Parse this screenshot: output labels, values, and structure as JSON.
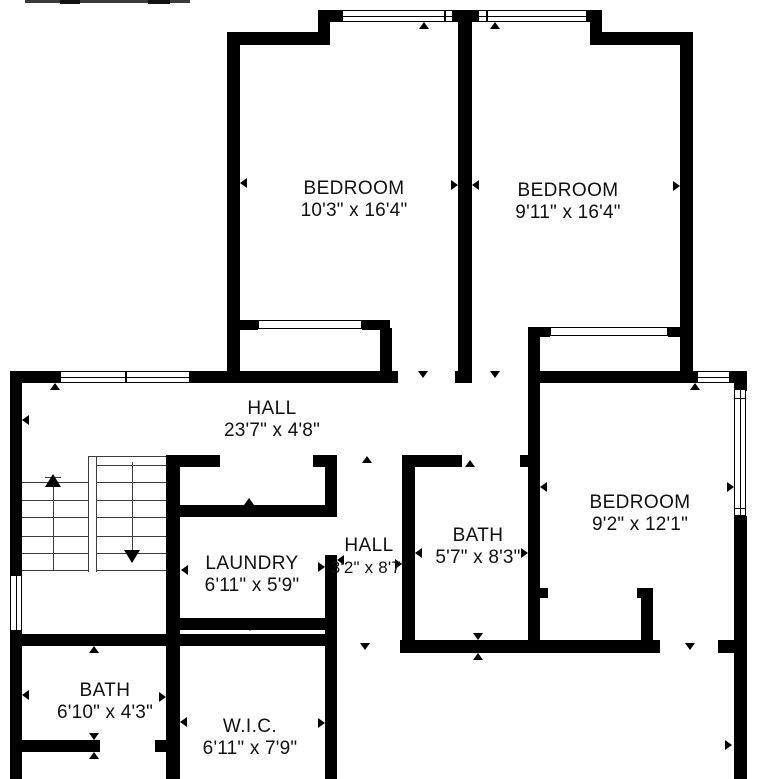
{
  "canvas": {
    "width": 779,
    "height": 779,
    "background": "#ffffff",
    "wall_color": "#000000",
    "stair_line_color": "#3d3d3d",
    "text_color": "#111111"
  },
  "rooms": [
    {
      "name": "BEDROOM",
      "dims": "10'3\" x 16'4\"",
      "x": 354,
      "y": 200,
      "small": false
    },
    {
      "name": "BEDROOM",
      "dims": "9'11\" x 16'4\"",
      "x": 568,
      "y": 202,
      "small": false
    },
    {
      "name": "HALL",
      "dims": "23'7\" x 4'8\"",
      "x": 272,
      "y": 420,
      "small": false
    },
    {
      "name": "BEDROOM",
      "dims": "9'2\" x 12'1\"",
      "x": 640,
      "y": 514,
      "small": false
    },
    {
      "name": "LAUNDRY",
      "dims": "6'11\" x 5'9\"",
      "x": 252,
      "y": 575,
      "small": false
    },
    {
      "name": "HALL",
      "dims": "3'2\" x 8'7\"",
      "x": 369,
      "y": 557,
      "small": true
    },
    {
      "name": "BATH",
      "dims": "5'7\" x 8'3\"",
      "x": 478,
      "y": 547,
      "small": false
    },
    {
      "name": "BATH",
      "dims": "6'10\" x 4'3\"",
      "x": 105,
      "y": 702,
      "small": false
    },
    {
      "name": "W.I.C.",
      "dims": "6'11\" x 7'9\"",
      "x": 250,
      "y": 738,
      "small": false
    }
  ],
  "walls": [
    [
      318,
      10,
      284,
      12
    ],
    [
      318,
      10,
      12,
      35
    ],
    [
      227,
      32,
      103,
      13
    ],
    [
      227,
      32,
      13,
      351
    ],
    [
      590,
      10,
      12,
      35
    ],
    [
      590,
      32,
      103,
      13
    ],
    [
      680,
      32,
      13,
      351
    ],
    [
      458,
      10,
      14,
      373
    ],
    [
      10,
      371,
      50,
      12
    ],
    [
      190,
      371,
      208,
      12
    ],
    [
      455,
      371,
      17,
      12
    ],
    [
      528,
      371,
      169,
      12
    ],
    [
      730,
      371,
      17,
      12
    ],
    [
      238,
      320,
      20,
      10
    ],
    [
      362,
      320,
      28,
      10
    ],
    [
      380,
      328,
      12,
      45
    ],
    [
      528,
      327,
      22,
      10
    ],
    [
      668,
      327,
      17,
      10
    ],
    [
      528,
      337,
      12,
      36
    ],
    [
      10,
      371,
      12,
      204
    ],
    [
      10,
      631,
      12,
      148
    ],
    [
      166,
      455,
      14,
      324
    ],
    [
      166,
      455,
      54,
      12
    ],
    [
      313,
      455,
      24,
      12
    ],
    [
      325,
      455,
      12,
      62
    ],
    [
      166,
      505,
      171,
      12
    ],
    [
      325,
      555,
      12,
      224
    ],
    [
      166,
      618,
      171,
      12
    ],
    [
      10,
      634,
      327,
      12
    ],
    [
      402,
      455,
      13,
      198
    ],
    [
      402,
      455,
      60,
      12
    ],
    [
      520,
      455,
      20,
      12
    ],
    [
      528,
      383,
      12,
      270
    ],
    [
      535,
      588,
      13,
      10
    ],
    [
      637,
      588,
      16,
      10
    ],
    [
      641,
      598,
      12,
      55
    ],
    [
      400,
      640,
      260,
      13
    ],
    [
      718,
      640,
      29,
      13
    ],
    [
      734,
      383,
      13,
      8
    ],
    [
      734,
      516,
      13,
      263
    ],
    [
      10,
      740,
      90,
      12
    ],
    [
      155,
      740,
      25,
      12
    ]
  ],
  "windows": [
    {
      "x": 342,
      "y": 10,
      "w": 111,
      "h": 12,
      "o": "h",
      "dividers": [
        0.93
      ]
    },
    {
      "x": 478,
      "y": 10,
      "w": 109,
      "h": 12,
      "o": "h",
      "dividers": [
        0.07
      ]
    },
    {
      "x": 60,
      "y": 371,
      "w": 130,
      "h": 12,
      "o": "h",
      "dividers": [
        0.5
      ]
    },
    {
      "x": 697,
      "y": 371,
      "w": 33,
      "h": 12,
      "o": "h",
      "dividers": []
    },
    {
      "x": 734,
      "y": 389,
      "w": 12,
      "h": 127,
      "o": "v",
      "dividers": [
        0.06,
        0.94
      ]
    },
    {
      "x": 10,
      "y": 575,
      "w": 12,
      "h": 56,
      "o": "v",
      "dividers": []
    }
  ],
  "sliding_doors": [
    {
      "x": 258,
      "y": 320,
      "w": 104,
      "h": 9
    },
    {
      "x": 550,
      "y": 327,
      "w": 118,
      "h": 9
    }
  ],
  "ticks": [
    {
      "x": 240,
      "y": 183,
      "d": "left"
    },
    {
      "x": 458,
      "y": 185,
      "d": "right"
    },
    {
      "x": 472,
      "y": 185,
      "d": "left"
    },
    {
      "x": 424,
      "y": 22,
      "d": "up"
    },
    {
      "x": 495,
      "y": 22,
      "d": "up"
    },
    {
      "x": 680,
      "y": 186,
      "d": "right"
    },
    {
      "x": 55,
      "y": 383,
      "d": "up"
    },
    {
      "x": 22,
      "y": 420,
      "d": "left"
    },
    {
      "x": 423,
      "y": 378,
      "d": "down"
    },
    {
      "x": 495,
      "y": 378,
      "d": "down"
    },
    {
      "x": 695,
      "y": 383,
      "d": "up"
    },
    {
      "x": 734,
      "y": 487,
      "d": "right"
    },
    {
      "x": 181,
      "y": 570,
      "d": "left"
    },
    {
      "x": 325,
      "y": 567,
      "d": "right"
    },
    {
      "x": 337,
      "y": 560,
      "d": "left"
    },
    {
      "x": 402,
      "y": 564,
      "d": "right"
    },
    {
      "x": 415,
      "y": 553,
      "d": "left"
    },
    {
      "x": 528,
      "y": 553,
      "d": "right"
    },
    {
      "x": 540,
      "y": 487,
      "d": "left"
    },
    {
      "x": 470,
      "y": 460,
      "d": "up"
    },
    {
      "x": 367,
      "y": 456,
      "d": "up"
    },
    {
      "x": 249,
      "y": 498,
      "d": "up"
    },
    {
      "x": 250,
      "y": 631,
      "d": "down"
    },
    {
      "x": 250,
      "y": 637,
      "d": "up"
    },
    {
      "x": 365,
      "y": 650,
      "d": "down"
    },
    {
      "x": 690,
      "y": 650,
      "d": "down"
    },
    {
      "x": 732,
      "y": 745,
      "d": "right"
    },
    {
      "x": 94,
      "y": 646,
      "d": "up"
    },
    {
      "x": 22,
      "y": 695,
      "d": "left"
    },
    {
      "x": 166,
      "y": 697,
      "d": "right"
    },
    {
      "x": 180,
      "y": 722,
      "d": "left"
    },
    {
      "x": 325,
      "y": 723,
      "d": "right"
    },
    {
      "x": 94,
      "y": 740,
      "d": "down"
    },
    {
      "x": 94,
      "y": 752,
      "d": "up"
    },
    {
      "x": 478,
      "y": 640,
      "d": "down"
    },
    {
      "x": 478,
      "y": 653,
      "d": "up"
    }
  ],
  "stairs": {
    "lines": [
      [
        88,
        456,
        88,
        572
      ],
      [
        96,
        456,
        96,
        572
      ],
      [
        88,
        456,
        166,
        456
      ],
      [
        22,
        482,
        88,
        482
      ],
      [
        22,
        500,
        88,
        500
      ],
      [
        22,
        517,
        88,
        517
      ],
      [
        22,
        536,
        88,
        536
      ],
      [
        22,
        553,
        88,
        553
      ],
      [
        22,
        570,
        88,
        570
      ],
      [
        96,
        465,
        166,
        465
      ],
      [
        96,
        482,
        166,
        482
      ],
      [
        96,
        500,
        166,
        500
      ],
      [
        96,
        517,
        166,
        517
      ],
      [
        96,
        536,
        166,
        536
      ],
      [
        96,
        553,
        166,
        553
      ],
      [
        96,
        570,
        166,
        570
      ],
      [
        53,
        486,
        53,
        570
      ],
      [
        45,
        477,
        61,
        477
      ],
      [
        132,
        462,
        132,
        562
      ]
    ],
    "arrows": [
      {
        "x": 53,
        "y": 474,
        "d": "up"
      },
      {
        "x": 132,
        "y": 576,
        "d": "down"
      }
    ]
  },
  "header_artifact": [
    [
      25,
      0,
      165,
      3,
      "#3a3a3a"
    ],
    [
      60,
      0,
      20,
      4,
      "#101010"
    ],
    [
      148,
      0,
      22,
      4,
      "#101010"
    ]
  ]
}
